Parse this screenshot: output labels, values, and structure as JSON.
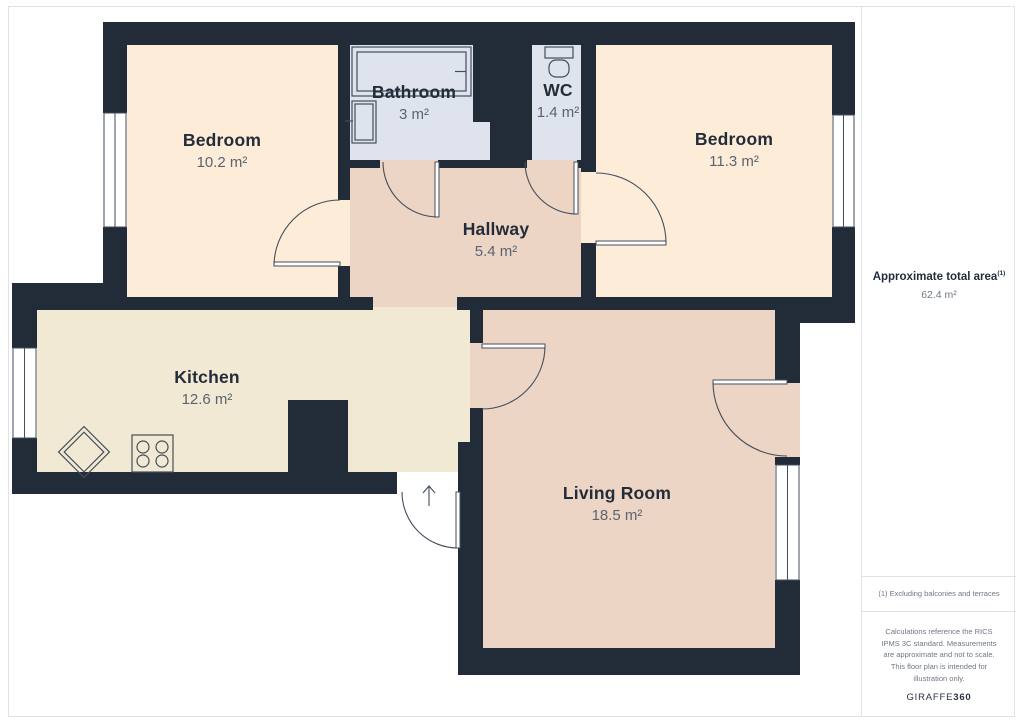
{
  "colors": {
    "wall": "#222b38",
    "bedroom": "#fdecd8",
    "kitchen": "#f1e9d3",
    "hall": "#edd5c5",
    "wet": "#dfe3ee",
    "outline": "#434e5c",
    "frame": "#e0e2e6",
    "name": "#232d3a",
    "value": "#5a6470",
    "muted": "#6e7884",
    "brand": "#2a3340"
  },
  "plan": {
    "rooms": [
      {
        "id": "bedroom-left",
        "name": "Bedroom",
        "area": "10.2 m²"
      },
      {
        "id": "bathroom",
        "name": "Bathroom",
        "area": "3 m²"
      },
      {
        "id": "wc",
        "name": "WC",
        "area": "1.4 m²"
      },
      {
        "id": "bedroom-right",
        "name": "Bedroom",
        "area": "11.3 m²"
      },
      {
        "id": "hallway",
        "name": "Hallway",
        "area": "5.4 m²"
      },
      {
        "id": "kitchen",
        "name": "Kitchen",
        "area": "12.6 m²"
      },
      {
        "id": "living-room",
        "name": "Living Room",
        "area": "18.5 m²"
      }
    ],
    "fixtures": [
      "bathtub",
      "bathroom-sink",
      "toilet",
      "kitchen-sink",
      "stove"
    ],
    "entrance_marker": "arrow-up"
  },
  "sidebar": {
    "total_label": "Approximate total area",
    "total_sup": "(1)",
    "total_value": "62.4 m²",
    "footnote": "(1) Excluding balconies and terraces",
    "disclaimer": "Calculations reference the RICS IPMS 3C standard. Measurements are approximate and not to scale. This floor plan is intended for illustration only.",
    "brand_regular": "GIRAFFE",
    "brand_bold": "360"
  }
}
